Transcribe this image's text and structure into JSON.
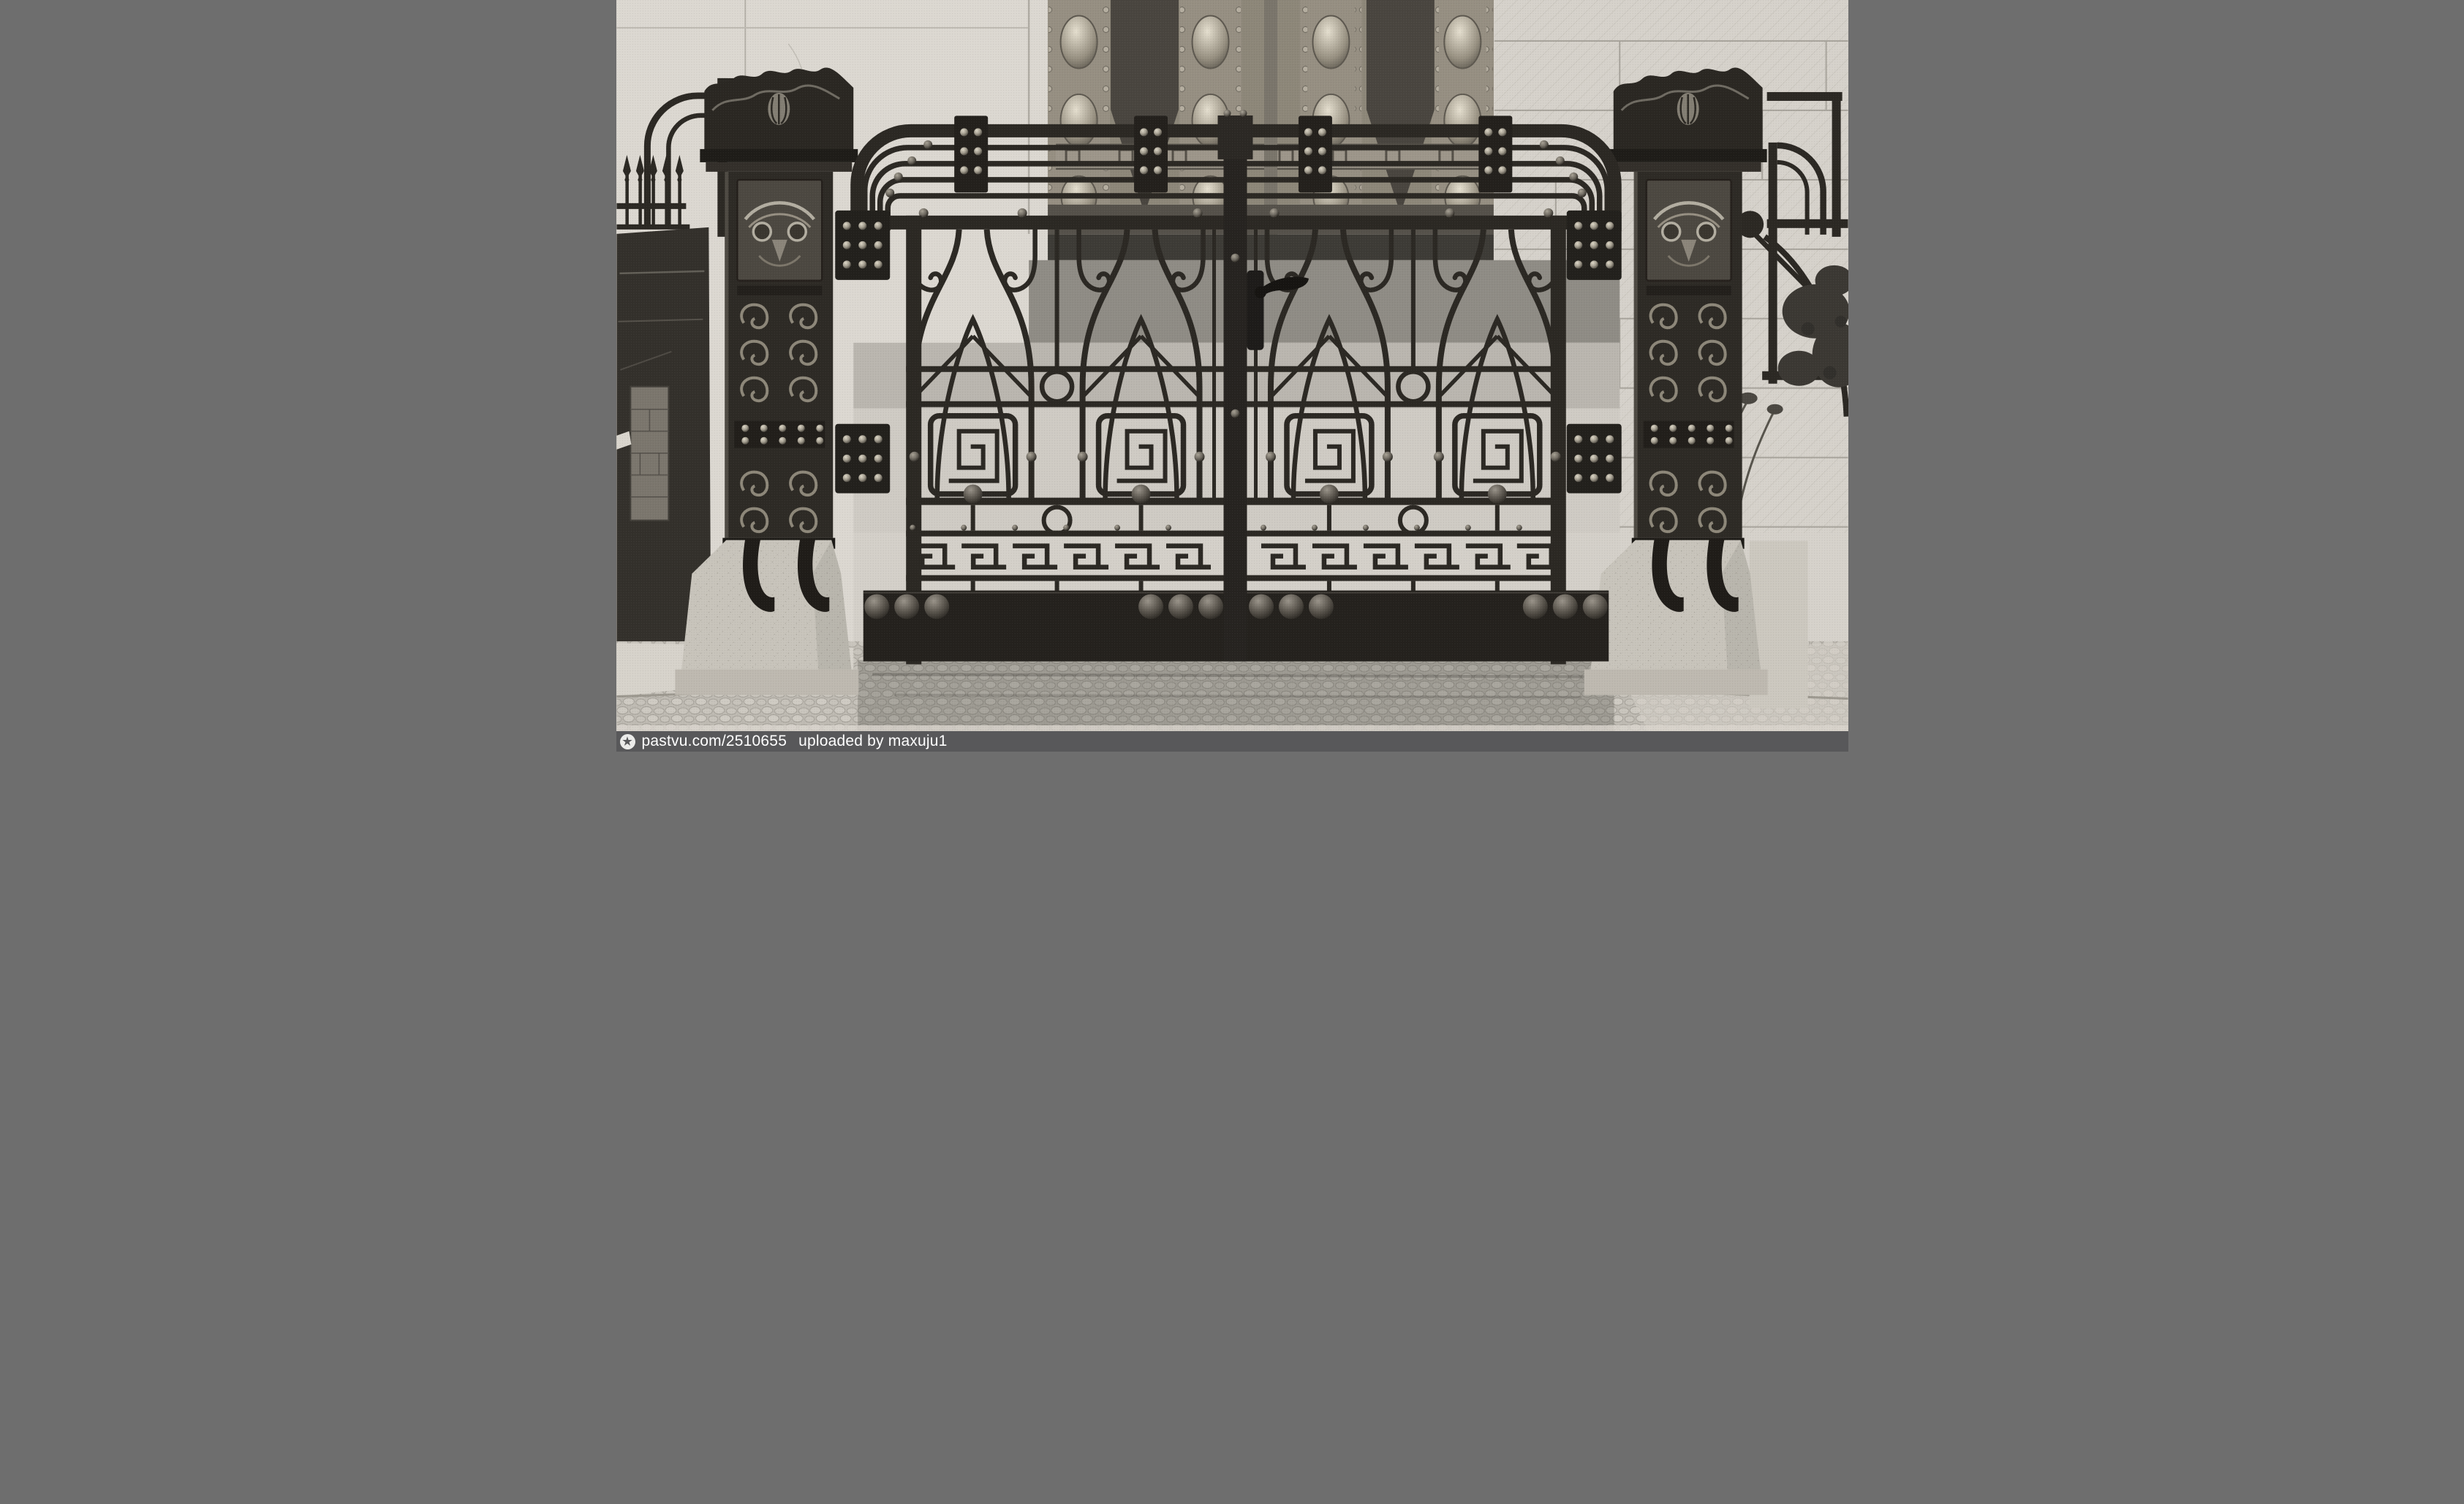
{
  "page": {
    "title": "Historic photograph — Art Nouveau wrought-iron gate"
  },
  "photo": {
    "kind": "black-and-white halftone photograph",
    "subject": "Art Nouveau wrought-iron double gate with studded plates, scroll and Greek-key ornament, flanking iron posts with owl-mask reliefs on granite bases, embossed bronze entrance door behind, rusticated stone facade, spiked side fence, shrubs and cobblestone pavement",
    "palette": {
      "wall": "#dcd8d1",
      "rusticated_wall": "#d6d2cb",
      "iron": "#2b2823",
      "iron_highlight": "#8d8779",
      "door_bronze": "#968f82",
      "door_panel_dark": "#49453f",
      "stone_base": "#c8c4bb",
      "pavement": "#bfbbb3",
      "step_shadow": "#8f8c85"
    }
  },
  "watermark": {
    "logo_icon": "pastvu-star-logo",
    "logo_glyph": "★",
    "site_label": "pastvu.com/2510655",
    "uploaded_label": "uploaded by maxuju1",
    "bar_color": "#58585a",
    "text_color": "#ffffff"
  }
}
